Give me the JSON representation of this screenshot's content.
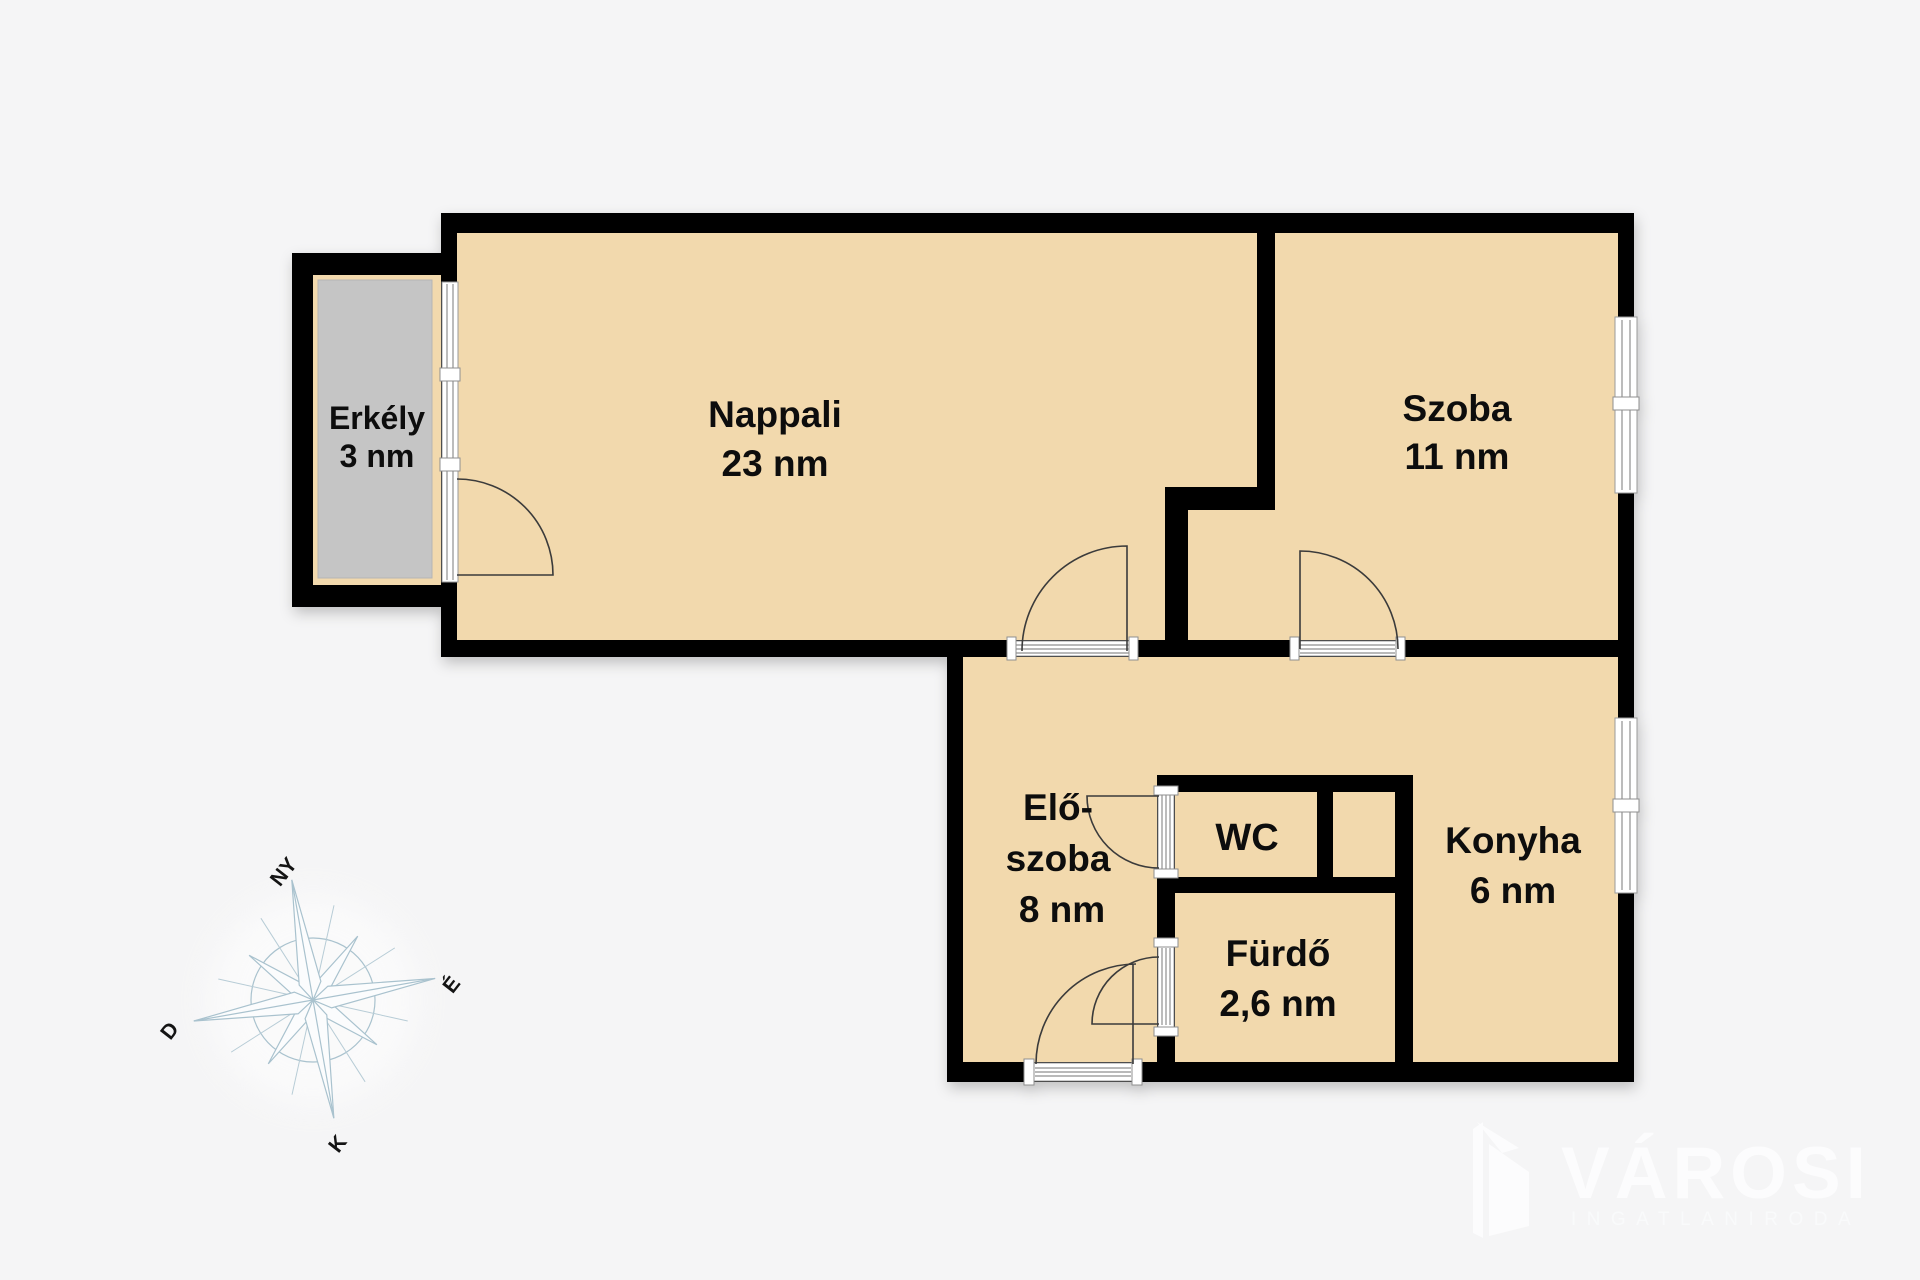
{
  "document": {
    "type": "apartment floor plan",
    "background_color": "#f5f5f6"
  },
  "colors": {
    "wall": "#000000",
    "floor": "#f2d9ad",
    "balcony_slab": "#c5c5c5",
    "threshold_line": "#8f8f8f",
    "door_arc": "#3a3a3a",
    "compass_stroke": "#a9c2ce",
    "logo_color": "#fcfcfd"
  },
  "rooms": {
    "erkely": {
      "name": "Erkély",
      "area": "3 nm"
    },
    "nappali": {
      "name": "Nappali",
      "area": "23 nm"
    },
    "szoba": {
      "name": "Szoba",
      "area": "11 nm"
    },
    "eloszoba": {
      "line1": "Elő-",
      "line2": "szoba",
      "area": "8 nm"
    },
    "wc": {
      "name": "WC"
    },
    "konyha": {
      "name": "Konyha",
      "area": "6 nm"
    },
    "furdo": {
      "name": "Fürdő",
      "area": "2,6 nm"
    }
  },
  "compass": {
    "ny": "NY",
    "e": "É",
    "d": "D",
    "k": "K"
  },
  "logo": {
    "title": "VÁROSI",
    "subtitle": "INGATLANIRODA"
  }
}
